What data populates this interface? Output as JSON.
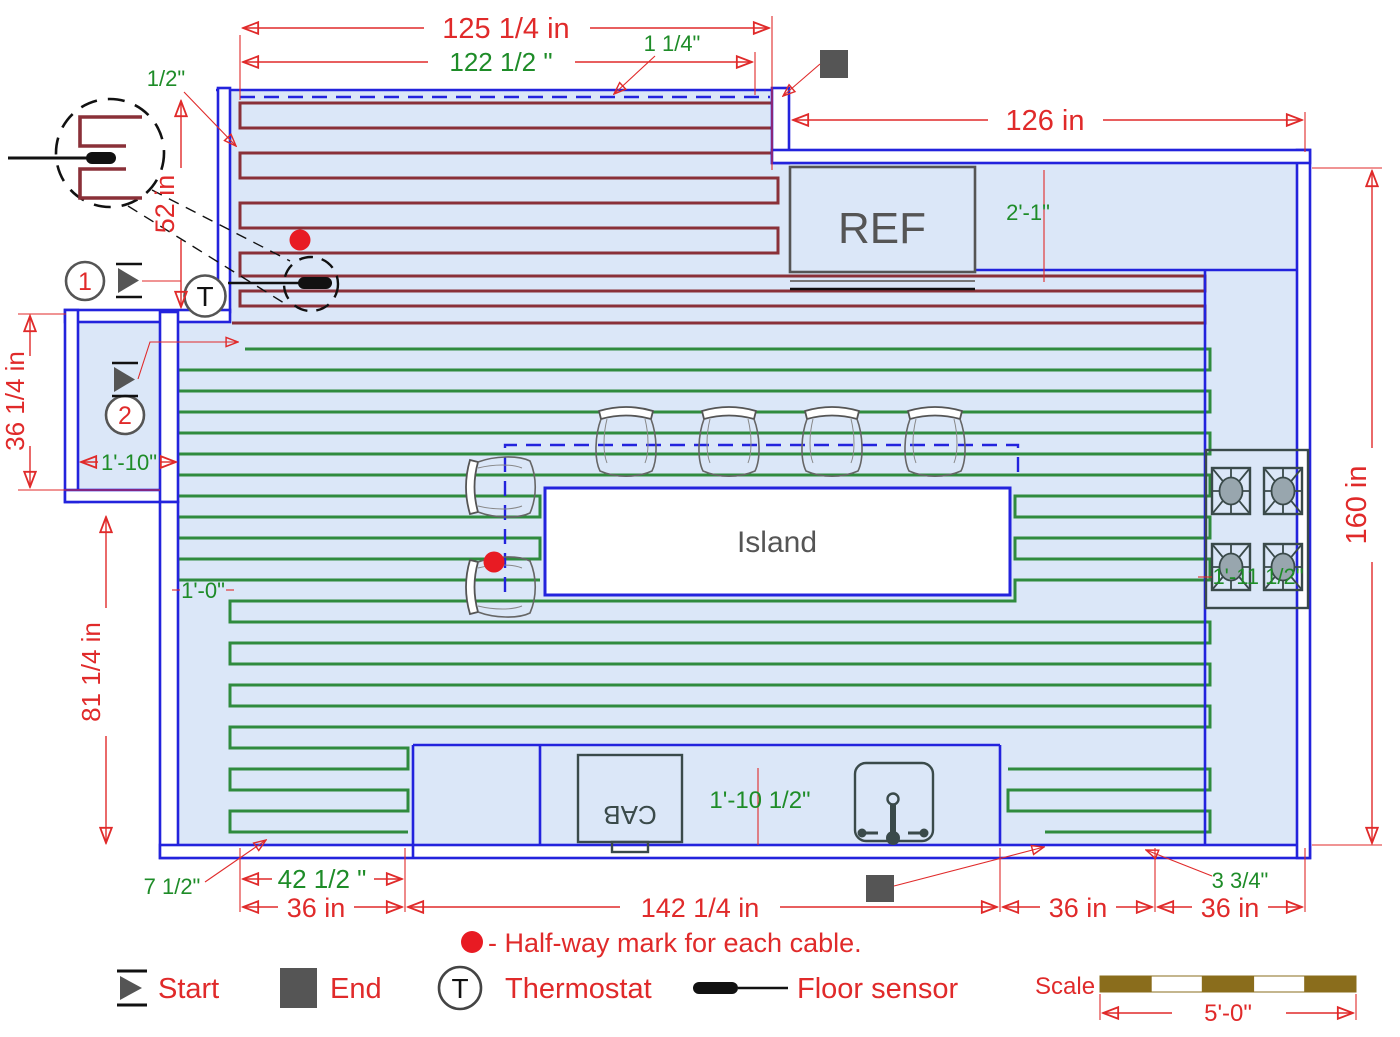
{
  "colors": {
    "wall": "#2323dd",
    "cable_zone1": "#8a3038",
    "cable_zone2": "#2f8b3e",
    "dim_red": "#e02a2a",
    "dim_green": "#1e8c28",
    "floor": "#dbe7f8",
    "marker_gray": "#555555",
    "scale_brown": "#8a6d1c",
    "halfway_red": "#e81b23"
  },
  "rooms": {
    "ref": "REF",
    "island": "Island",
    "cab": "CAB"
  },
  "dims": {
    "top_outer": "125 1/4 in",
    "top_inner": "122 1/2 \"",
    "cable_offset": "1 1/4\"",
    "wall_offset": "1/2\"",
    "top_right": "126 in",
    "ref_clearance": "2'-1\"",
    "left_upper": "52 in",
    "left_alcove": "36 1/4 in",
    "left_lower": "81 1/4 in",
    "right_side": "160 in",
    "alcove_width": "1'-10\"",
    "corridor_width": "1'-0\"",
    "stove_clearance": "1'-11 1/2\"",
    "sink_clearance": "1'-10 1/2\"",
    "corner_offset": "7 1/2\"",
    "cabinet_width": "42 1/2 \"",
    "stove_offset": "3 3/4\"",
    "bottom_left": "36 in",
    "bottom_mid": "142 1/4 in",
    "bottom_right1": "36 in",
    "bottom_right2": "36 in",
    "scale_length": "5'-0\""
  },
  "legend": {
    "halfway": "- Half-way mark for each cable.",
    "start": "Start",
    "end": "End",
    "thermostat": "Thermostat",
    "floor_sensor": "Floor sensor",
    "scale": "Scale"
  },
  "markers": {
    "cable1": "1",
    "cable2": "2",
    "thermostat": "T"
  }
}
